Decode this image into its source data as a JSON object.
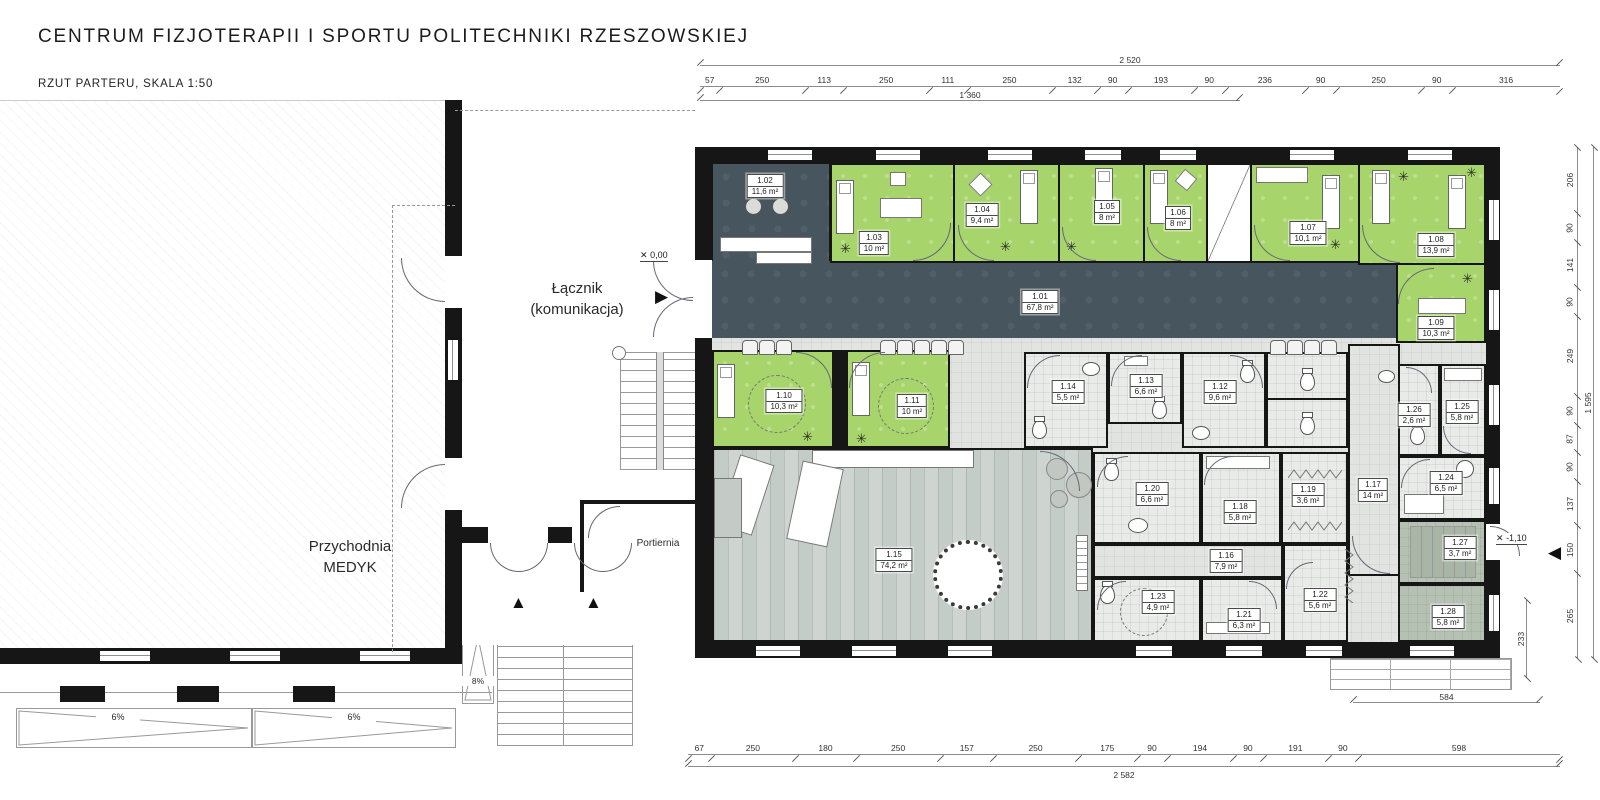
{
  "header": {
    "title": "CENTRUM FIZJOTERAPII I SPORTU POLITECHNIKI RZESZOWSKIEJ",
    "subtitle": "RZUT PARTERU, SKALA 1:50"
  },
  "legend": {
    "col_room": "Pomieszczenie",
    "col_area": "Powierzchnia",
    "rows": [
      {
        "name": "1.01 Hol",
        "area": "67,80 m²"
      },
      {
        "name": "1.02. Recepcja",
        "area": "11,60 m²"
      },
      {
        "name": "1.03 Gabinet konsultacyjny",
        "area": "10,00 m²"
      },
      {
        "name": "1.04 Gabinet do krioterapii miejscowej",
        "area": "9,40 m²"
      },
      {
        "name": "1.05 Gabinet terapii indywidualnej",
        "area": "8,00 m²"
      },
      {
        "name": "1.06 Gabinet terapii indywidualnej",
        "area": "8,00 m²"
      },
      {
        "name": "1.07 Gabinet do fizykoterapii-magnetoterapia",
        "area": "10,10 m²"
      },
      {
        "name": "1.08 Gabinet do światłolecznictwa",
        "area": "13,90 m²"
      },
      {
        "name": "1.09 Gabinet do laseroterapii",
        "area": "10,30 m²"
      },
      {
        "name": "1.10 Gabinet do elektroterapii i ultradźwięków",
        "area": "10,30 m²"
      },
      {
        "name": "1.11 Gabinet do terapii fali uderzeniowej",
        "area": "10,00 m²"
      },
      {
        "name": "1.12 Toaleta damska",
        "area": "9,60 m²"
      },
      {
        "name": "1.13 Toaleta męska",
        "area": "6,60 m²"
      },
      {
        "name": "1.14 Toaleta dla niepełnosprawnego",
        "area": "5,50 m²"
      },
      {
        "name": "1.15 Salka do ćwiczeń",
        "area": "74,20 m²"
      },
      {
        "name": "1.16 Komunikacja 1",
        "area": "7,90 m²"
      },
      {
        "name": "1.17 Komunikacja 2",
        "area": "14,00 m²"
      },
      {
        "name": "1.18 Szatnia damska",
        "area": "5,80 m²"
      },
      {
        "name": "1.19 Prysznice damskie",
        "area": "3,60 m²"
      },
      {
        "name": "1.20 Toaleta damska",
        "area": "6,60 m²"
      },
      {
        "name": "1.21 Szatnia męska",
        "area": "6,30 m²"
      },
      {
        "name": "1.22 Prysznice męskie",
        "area": "5,60 m²"
      },
      {
        "name": "1.23 Toaleta męska",
        "area": "4,90 m²"
      },
      {
        "name": "1.24 Pokój socjalny",
        "area": "6,50 m²"
      },
      {
        "name": "1.25 Szatnia personelu",
        "area": "5,80 m²"
      },
      {
        "name": "1.26 Toaleta personelu",
        "area": "2,60 m²"
      },
      {
        "name": "1.27 Klatka schodowa (techniczna)",
        "area": "3,70 m²"
      },
      {
        "name": "1.28. Pomieszczenie gospodarcze",
        "area": "5,80 m²"
      }
    ]
  },
  "plan": {
    "labels": {
      "r101": {
        "num": "1.01",
        "area": "67,8 m²"
      },
      "r102": {
        "num": "1.02",
        "area": "11,6 m²"
      },
      "r103": {
        "num": "1.03",
        "area": "10 m²"
      },
      "r104": {
        "num": "1.04",
        "area": "9,4 m²"
      },
      "r105": {
        "num": "1.05",
        "area": "8 m²"
      },
      "r106": {
        "num": "1.06",
        "area": "8 m²"
      },
      "r107": {
        "num": "1.07",
        "area": "10,1 m²"
      },
      "r108": {
        "num": "1.08",
        "area": "13,9 m²"
      },
      "r109": {
        "num": "1.09",
        "area": "10,3 m²"
      },
      "r110": {
        "num": "1.10",
        "area": "10,3 m²"
      },
      "r111": {
        "num": "1.11",
        "area": "10 m²"
      },
      "r112": {
        "num": "1.12",
        "area": "9,6 m²"
      },
      "r113": {
        "num": "1.13",
        "area": "6,6 m²"
      },
      "r114": {
        "num": "1.14",
        "area": "5,5 m²"
      },
      "r115": {
        "num": "1.15",
        "area": "74,2 m²"
      },
      "r116": {
        "num": "1.16",
        "area": "7,9 m²"
      },
      "r117": {
        "num": "1.17",
        "area": "14 m²"
      },
      "r118": {
        "num": "1.18",
        "area": "5,8 m²"
      },
      "r119": {
        "num": "1.19",
        "area": "3,6 m²"
      },
      "r120": {
        "num": "1.20",
        "area": "6,6 m²"
      },
      "r121": {
        "num": "1.21",
        "area": "6,3 m²"
      },
      "r122": {
        "num": "1.22",
        "area": "5,6 m²"
      },
      "r123": {
        "num": "1.23",
        "area": "4,9 m²"
      },
      "r124": {
        "num": "1.24",
        "area": "6,5 m²"
      },
      "r125": {
        "num": "1.25",
        "area": "5,8 m²"
      },
      "r126": {
        "num": "1.26",
        "area": "2,6 m²"
      },
      "r127": {
        "num": "1.27",
        "area": "3,7 m²"
      },
      "r128": {
        "num": "1.28",
        "area": "5,8 m²"
      }
    },
    "texts": {
      "lacznik_line1": "Łącznik",
      "lacznik_line2": "(komunikacja)",
      "przychodnia_line1": "Przychodnia",
      "przychodnia_line2": "MEDYK",
      "portiernia": "Portiernia"
    },
    "levels": {
      "zero": "0,00",
      "minus": "-1,10"
    },
    "ramps": {
      "r1": "6%",
      "r2": "6%",
      "r3": "8%"
    }
  },
  "icons": {
    "stool": "✳",
    "level_cross": "✕",
    "arrow_right": "▶",
    "arrow_up": "▲",
    "arrow_left": "◀"
  },
  "dims": {
    "top": {
      "overall": "2 520",
      "sub": "1 360",
      "segs": [
        {
          "v": 57,
          "label": "57"
        },
        {
          "v": 250,
          "label": "250"
        },
        {
          "v": 113,
          "label": "113"
        },
        {
          "v": 250,
          "label": "250"
        },
        {
          "v": 111,
          "label": "111"
        },
        {
          "v": 250,
          "label": "250"
        },
        {
          "v": 132,
          "label": "132"
        },
        {
          "v": 90,
          "label": "90"
        },
        {
          "v": 193,
          "label": "193"
        },
        {
          "v": 90,
          "label": "90"
        },
        {
          "v": 236,
          "label": "236"
        },
        {
          "v": 90,
          "label": "90"
        },
        {
          "v": 250,
          "label": "250"
        },
        {
          "v": 90,
          "label": "90"
        },
        {
          "v": 316,
          "label": "316"
        }
      ]
    },
    "bottom": {
      "overall": "2 582",
      "extra": "584",
      "segs": [
        {
          "v": 67,
          "label": "67"
        },
        {
          "v": 250,
          "label": "250"
        },
        {
          "v": 180,
          "label": "180"
        },
        {
          "v": 250,
          "label": "250"
        },
        {
          "v": 157,
          "label": "157"
        },
        {
          "v": 250,
          "label": "250"
        },
        {
          "v": 175,
          "label": "175"
        },
        {
          "v": 90,
          "label": "90"
        },
        {
          "v": 194,
          "label": "194"
        },
        {
          "v": 90,
          "label": "90"
        },
        {
          "v": 191,
          "label": "191"
        },
        {
          "v": 90,
          "label": "90"
        },
        {
          "v": 598,
          "label": "598"
        }
      ]
    },
    "right": {
      "overall": "1 595",
      "inner": "233",
      "inner2": "265",
      "segs": [
        {
          "v": 206,
          "label": "206"
        },
        {
          "v": 90,
          "label": "90"
        },
        {
          "v": 141,
          "label": "141"
        },
        {
          "v": 90,
          "label": "90"
        },
        {
          "v": 249,
          "label": "249"
        },
        {
          "v": 90,
          "label": "90"
        },
        {
          "v": 87,
          "label": "87"
        },
        {
          "v": 90,
          "label": "90"
        },
        {
          "v": 137,
          "label": "137"
        },
        {
          "v": 150,
          "label": "150"
        },
        {
          "v": 265,
          "label": "265"
        }
      ]
    }
  },
  "colors": {
    "wall": "#161616",
    "therapy_green": "#a7d46b",
    "hall_dark": "#46555e",
    "floor_light": "#e1e4e1",
    "wood": "#cbd2ce",
    "sage": "#b5c1b2"
  }
}
